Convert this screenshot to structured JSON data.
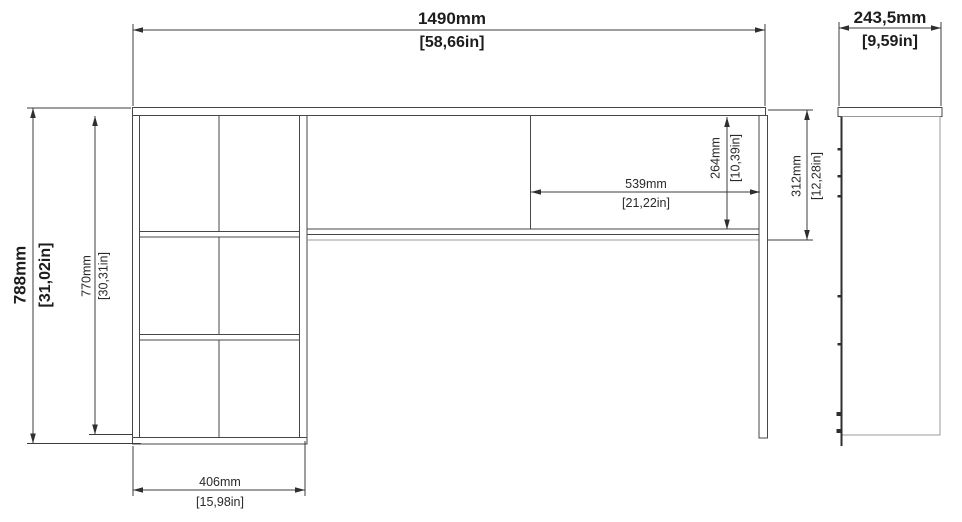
{
  "drawing": {
    "type": "furniture-technical-drawing",
    "subject": "corner desk with bookcase side unit",
    "views": {
      "front": "front elevation",
      "side": "side elevation"
    }
  },
  "colors": {
    "background": "#ffffff",
    "object_line": "#474747",
    "light_line": "#9b9b9b",
    "dimension_line": "#3c3c3c",
    "text": "#1d1d1d"
  },
  "dimensions": {
    "overall_width": {
      "mm": "1490mm",
      "inch": "[58,66in]"
    },
    "side_depth": {
      "mm": "243,5mm",
      "inch": "[9,59in]"
    },
    "overall_height": {
      "mm": "788mm",
      "inch": "[31,02in]"
    },
    "bookcase_height": {
      "mm": "770mm",
      "inch": "[30,31in]"
    },
    "back_panel_width": {
      "mm": "539mm",
      "inch": "[21,22in]"
    },
    "back_panel_height": {
      "mm": "264mm",
      "inch": "[10,39in]"
    },
    "right_side_height": {
      "mm": "312mm",
      "inch": "[12,28in]"
    },
    "bookcase_width": {
      "mm": "406mm",
      "inch": "[15,98in]"
    }
  }
}
